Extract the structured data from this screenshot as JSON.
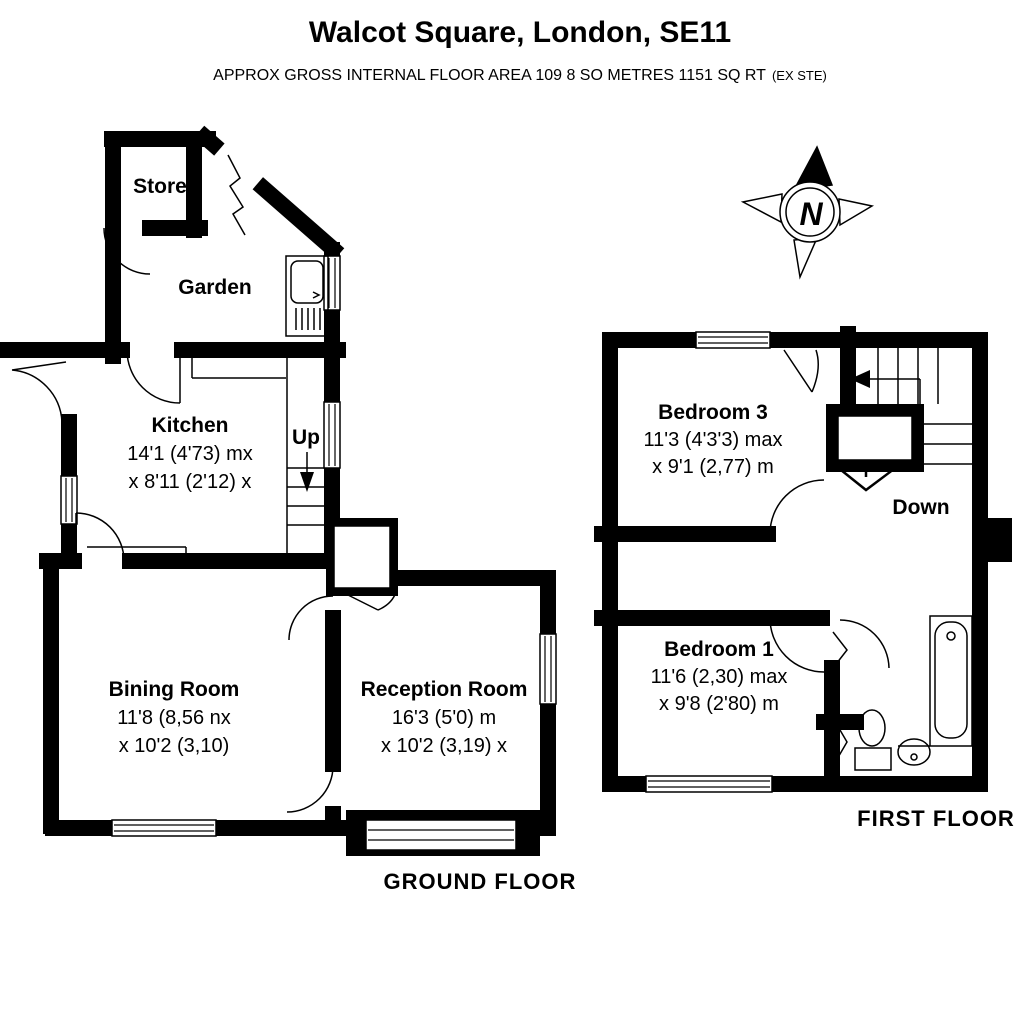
{
  "header": {
    "title": "Walcot Square, London, SE11",
    "subtitle_main": "APPROX  GROSS INTERNAL FLOOR AREA 109 8 SO METRES  1151 SQ RT",
    "subtitle_suffix": "(EX STE)"
  },
  "compass": {
    "north_label": "N"
  },
  "ground_floor": {
    "label": "GROUND FLOOR",
    "store": {
      "name": "Store"
    },
    "garden": {
      "name": "Garden"
    },
    "kitchen": {
      "name": "Kitchen",
      "dim1": "14'1 (4'73) mx",
      "dim2": "x 8'11 (2'12) x"
    },
    "stairs": {
      "label": "Up"
    },
    "dining": {
      "name": "Bining Room",
      "dim1": "11'8 (8,56 nx",
      "dim2": "x 10'2 (3,10)"
    },
    "reception": {
      "name": "Reception Room",
      "dim1": "16'3 (5'0) m",
      "dim2": "x 10'2 (3,19) x"
    }
  },
  "first_floor": {
    "label": "FIRST FLOOR",
    "bedroom3": {
      "name": "Bedroom 3",
      "dim1": "11'3 (4'3'3) max",
      "dim2": "x 9'1 (2,77) m"
    },
    "stairs": {
      "label": "Down"
    },
    "bedroom1": {
      "name": "Bedroom 1",
      "dim1": "11'6 (2,30) max",
      "dim2": "x 9'8 (2'80) m"
    }
  },
  "colors": {
    "wall": "#000000",
    "background": "#ffffff",
    "text": "#000000"
  }
}
